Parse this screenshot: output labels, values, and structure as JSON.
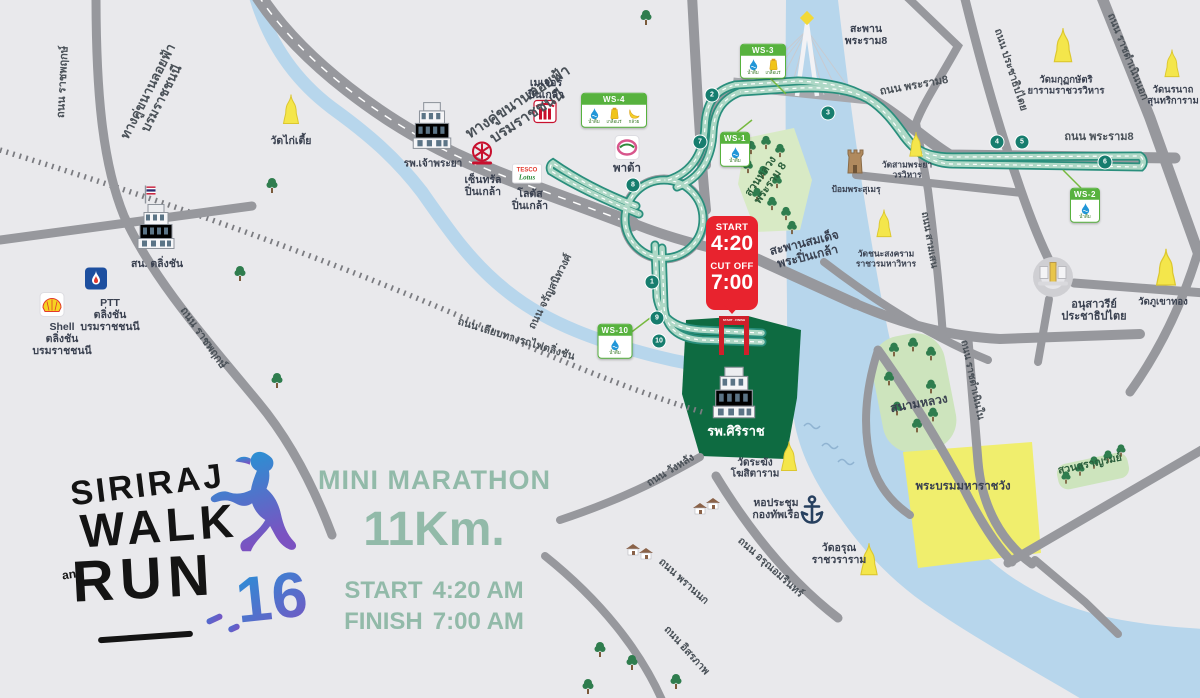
{
  "colors": {
    "background": "#e9e9ec",
    "road_gray": "#97989d",
    "route_teal": "#2a8f7d",
    "route_fill": "#aed8c6",
    "river_blue": "#b7d6ec",
    "park_green": "#cde4bd",
    "siriraj_green": "#0e6b41",
    "palace_yellow": "#f0ee6d",
    "temple_yellow": "#f4e64b",
    "ws_green": "#57b23e",
    "start_red": "#e8232e",
    "sage_text": "#92baa9",
    "label_dark": "#3a4150",
    "logo_gradient_start": "#2196d9",
    "logo_gradient_end": "#7b52c1"
  },
  "logo": {
    "siriraj": "SIRIRAJ",
    "walk": "WALK",
    "and": "and",
    "run": "RUN",
    "number": "16"
  },
  "info": {
    "title": "MINI MARATHON",
    "distance": "11Km.",
    "start_label": "START",
    "start_value": "4:20 AM",
    "finish_label": "FINISH",
    "finish_value": "7:00 AM"
  },
  "start_badge": {
    "start_label": "START",
    "start_time": "4:20",
    "cutoff_label": "CUT OFF",
    "cutoff_time": "7:00"
  },
  "start_gate": {
    "label": "START - FINISH"
  },
  "ws_items": {
    "water": "น้ำดื่ม",
    "electrolyte": "เกลือแร่",
    "banana": "กล้วย"
  },
  "water_stations": [
    {
      "id": "WS-1",
      "x": 735,
      "y": 149,
      "items": [
        "water"
      ]
    },
    {
      "id": "WS-2",
      "x": 1085,
      "y": 205,
      "items": [
        "water"
      ]
    },
    {
      "id": "WS-3",
      "x": 763,
      "y": 61,
      "items": [
        "water",
        "electrolyte"
      ]
    },
    {
      "id": "WS-4",
      "x": 614,
      "y": 110,
      "items": [
        "water",
        "electrolyte",
        "banana"
      ]
    },
    {
      "id": "WS-10",
      "x": 615,
      "y": 341,
      "items": [
        "water"
      ]
    }
  ],
  "km_markers": [
    {
      "n": "1",
      "x": 652,
      "y": 282
    },
    {
      "n": "2",
      "x": 712,
      "y": 95
    },
    {
      "n": "3",
      "x": 828,
      "y": 113
    },
    {
      "n": "4",
      "x": 997,
      "y": 142
    },
    {
      "n": "5",
      "x": 1022,
      "y": 142
    },
    {
      "n": "6",
      "x": 1105,
      "y": 162
    },
    {
      "n": "7",
      "x": 700,
      "y": 142
    },
    {
      "n": "8",
      "x": 633,
      "y": 185
    },
    {
      "n": "9",
      "x": 657,
      "y": 318
    },
    {
      "n": "10",
      "x": 659,
      "y": 341
    }
  ],
  "labels": [
    {
      "name": "road-label-elevated-parallel-west",
      "lines": [
        "ทางคู่ขนานลอยฟ้า",
        "บรมราชชนนี"
      ],
      "x": 155,
      "y": 95,
      "rot": -63,
      "size": 13,
      "color": "#4a5158"
    },
    {
      "name": "road-label-elevated-parallel",
      "lines": [
        "ทางคู่ขนานลอยฟ้า",
        "บรมราชชนนี"
      ],
      "x": 523,
      "y": 110,
      "rot": -33,
      "size": 15,
      "color": "#4a5158"
    },
    {
      "name": "road-label-ratchaphruek-north",
      "lines": [
        "ถนน ราชพฤกษ์"
      ],
      "x": 63,
      "y": 82,
      "rot": -87,
      "size": 11,
      "color": "#4a5158"
    },
    {
      "name": "road-label-ratchaphruek-south",
      "lines": [
        "ถนน ราชพฤกษ์"
      ],
      "x": 203,
      "y": 338,
      "rot": 55,
      "size": 11,
      "color": "#4a5158"
    },
    {
      "name": "road-label-railway-side",
      "lines": [
        "ถนน เลียบทางรถไฟตลิ่งชัน"
      ],
      "x": 516,
      "y": 340,
      "rot": 17,
      "size": 10.5,
      "color": "#4a5158"
    },
    {
      "name": "road-label-charansanitwong",
      "lines": [
        "ถนน จรัญสนิทวงศ์"
      ],
      "x": 551,
      "y": 292,
      "rot": -63,
      "size": 10.5,
      "color": "#4a5158"
    },
    {
      "name": "road-label-rama8-west",
      "lines": [
        "ถนน พระราม8"
      ],
      "x": 914,
      "y": 86,
      "rot": -10,
      "size": 11,
      "color": "#4a5158"
    },
    {
      "name": "road-label-rama8-east",
      "lines": [
        "ถนน พระราม8"
      ],
      "x": 1099,
      "y": 137,
      "rot": 0,
      "size": 11,
      "color": "#4a5158"
    },
    {
      "name": "road-label-prachathipatai",
      "lines": [
        "ถนน ประชาธิปไตย"
      ],
      "x": 1010,
      "y": 70,
      "rot": 72,
      "size": 10.5,
      "color": "#4a5158"
    },
    {
      "name": "road-label-ratchadamnoen-nok",
      "lines": [
        "ถนน ราชดำเนินนอก"
      ],
      "x": 1127,
      "y": 57,
      "rot": 68,
      "size": 10.5,
      "color": "#4a5158"
    },
    {
      "name": "road-label-samsen",
      "lines": [
        "ถนน สามเสน"
      ],
      "x": 929,
      "y": 240,
      "rot": 80,
      "size": 10,
      "color": "#4a5158"
    },
    {
      "name": "road-label-ratchadamnoen-nai",
      "lines": [
        "ถนน ราชดำเนินใน"
      ],
      "x": 972,
      "y": 380,
      "rot": 78,
      "size": 10,
      "color": "#4a5158"
    },
    {
      "name": "road-label-wanglang",
      "lines": [
        "ถนน วังหลัง"
      ],
      "x": 671,
      "y": 471,
      "rot": -31,
      "size": 10.5,
      "color": "#4a5158"
    },
    {
      "name": "road-label-phrannok",
      "lines": [
        "ถนน พรานนก"
      ],
      "x": 683,
      "y": 582,
      "rot": 42,
      "size": 10.5,
      "color": "#4a5158"
    },
    {
      "name": "road-label-arunamarin",
      "lines": [
        "ถนน อรุณอมรินทร์"
      ],
      "x": 770,
      "y": 568,
      "rot": 42,
      "size": 10.5,
      "color": "#4a5158"
    },
    {
      "name": "road-label-itsaraphap",
      "lines": [
        "ถนน อิสรภาพ"
      ],
      "x": 686,
      "y": 651,
      "rot": 48,
      "size": 10.5,
      "color": "#4a5158"
    },
    {
      "name": "label-wat-kai-tia",
      "lines": [
        "วัดไก่เตี้ย"
      ],
      "x": 291,
      "y": 142,
      "rot": 0,
      "size": 10.5
    },
    {
      "name": "label-taling-chan-police",
      "lines": [
        "สน. ตลิ่งชัน"
      ],
      "x": 157,
      "y": 265,
      "rot": 0,
      "size": 10.5
    },
    {
      "name": "label-ptt-station",
      "lines": [
        "PTT",
        "ตลิ่งชัน",
        "บรมราชชนนี"
      ],
      "x": 110,
      "y": 316,
      "rot": 0,
      "size": 10.5
    },
    {
      "name": "label-shell-station",
      "lines": [
        "Shell",
        "ตลิ่งชัน",
        "บรมราชชนนี"
      ],
      "x": 62,
      "y": 340,
      "rot": 0,
      "size": 10.5
    },
    {
      "name": "label-chaophraya-hospital",
      "lines": [
        "รพ.เจ้าพระยา"
      ],
      "x": 433,
      "y": 164,
      "rot": 0,
      "size": 10
    },
    {
      "name": "label-central-pinklao",
      "lines": [
        "เซ็นทรัล",
        "ปิ่นเกล้า"
      ],
      "x": 483,
      "y": 187,
      "rot": 0,
      "size": 10.5
    },
    {
      "name": "label-major-pinklao",
      "lines": [
        "เมเจอร์",
        "ปิ่นเกล้า"
      ],
      "x": 546,
      "y": 90,
      "rot": 0,
      "size": 10.5
    },
    {
      "name": "label-lotus-pinklao",
      "lines": [
        "โลตัส",
        "ปิ่นเกล้า"
      ],
      "x": 530,
      "y": 201,
      "rot": 0,
      "size": 10.5
    },
    {
      "name": "label-pata",
      "lines": [
        "พาต้า"
      ],
      "x": 627,
      "y": 169,
      "rot": 0,
      "size": 11.5
    },
    {
      "name": "label-rama8-bridge",
      "lines": [
        "สะพาน",
        "พระราม8"
      ],
      "x": 866,
      "y": 36,
      "rot": 0,
      "size": 10.5
    },
    {
      "name": "label-wat-makut",
      "lines": [
        "วัดมกุฏกษัตริ",
        "ยารามราชวรวิหาร"
      ],
      "x": 1066,
      "y": 86,
      "rot": 0,
      "size": 9.5
    },
    {
      "name": "label-wat-noranat",
      "lines": [
        "วัดนรนาถ",
        "สุนทริการาม"
      ],
      "x": 1173,
      "y": 96,
      "rot": 0,
      "size": 9.5
    },
    {
      "name": "label-rama8-park",
      "lines": [
        "สวนหลวง",
        "พระราม 8"
      ],
      "x": 766,
      "y": 180,
      "rot": -55,
      "size": 11,
      "color": "#2c5f3c"
    },
    {
      "name": "label-phra-sumen-fort",
      "lines": [
        "ป้อมพระสุเมรุ"
      ],
      "x": 856,
      "y": 190,
      "rot": 0,
      "size": 8.5
    },
    {
      "name": "label-wat-samphraya",
      "lines": [
        "วัดสามพระยา",
        "วรวิหาร"
      ],
      "x": 907,
      "y": 170,
      "rot": 0,
      "size": 8.5
    },
    {
      "name": "label-wat-chanasongkhram",
      "lines": [
        "วัดชนะสงคราม",
        "ราชวรมหาวิหาร"
      ],
      "x": 886,
      "y": 259,
      "rot": 0,
      "size": 8.5
    },
    {
      "name": "label-pinklao-bridge",
      "lines": [
        "สะพานสมเด็จ",
        "พระปิ่นเกล้า"
      ],
      "x": 806,
      "y": 250,
      "rot": -14,
      "size": 12
    },
    {
      "name": "label-democracy-monument",
      "lines": [
        "อนุสาวรีย์",
        "ประชาธิปไตย"
      ],
      "x": 1094,
      "y": 311,
      "rot": 0,
      "size": 11
    },
    {
      "name": "label-wat-phukhaothong",
      "lines": [
        "วัดภูเขาทอง"
      ],
      "x": 1163,
      "y": 303,
      "rot": 0,
      "size": 9.5
    },
    {
      "name": "label-sanam-luang",
      "lines": [
        "สนามหลวง"
      ],
      "x": 919,
      "y": 404,
      "rot": -10,
      "size": 12
    },
    {
      "name": "label-grand-palace",
      "lines": [
        "พระบรมมหาราชวัง"
      ],
      "x": 963,
      "y": 487,
      "rot": 0,
      "size": 11.5
    },
    {
      "name": "label-saranrom-park",
      "lines": [
        "สวนสราญรมย์"
      ],
      "x": 1090,
      "y": 465,
      "rot": -12,
      "size": 10.5,
      "color": "#2c5f3c"
    },
    {
      "name": "label-siriraj-hospital",
      "lines": [
        "รพ.ศิริราช"
      ],
      "x": 736,
      "y": 432,
      "rot": 0,
      "size": 13,
      "color": "#ffffff"
    },
    {
      "name": "label-wat-rakhang",
      "lines": [
        "วัดระฆัง",
        "โฆสิตาราม"
      ],
      "x": 755,
      "y": 469,
      "rot": 0,
      "size": 10
    },
    {
      "name": "label-navy-hall",
      "lines": [
        "หอประชุม",
        "กองทัพเรือ"
      ],
      "x": 776,
      "y": 510,
      "rot": 0,
      "size": 10.5
    },
    {
      "name": "label-wat-arun",
      "lines": [
        "วัดอรุณ",
        "ราชวราราม"
      ],
      "x": 839,
      "y": 555,
      "rot": 0,
      "size": 10.5
    }
  ],
  "landmarks": [
    {
      "name": "wat-kai-tia-temple-icon",
      "icon": "temple-icon",
      "x": 291,
      "y": 112,
      "s": 1
    },
    {
      "name": "wat-makut-temple-icon",
      "icon": "temple-icon",
      "x": 1063,
      "y": 48,
      "s": 1.15
    },
    {
      "name": "wat-noranat-temple-icon",
      "icon": "temple-icon",
      "x": 1172,
      "y": 66,
      "s": 0.95
    },
    {
      "name": "wat-samphraya-temple-icon",
      "icon": "temple-icon",
      "x": 916,
      "y": 147,
      "s": 0.85
    },
    {
      "name": "wat-chanasongkhram-temple-icon",
      "icon": "temple-icon",
      "x": 884,
      "y": 226,
      "s": 0.95
    },
    {
      "name": "wat-phukhaothong-temple-icon",
      "icon": "temple-icon",
      "x": 1166,
      "y": 270,
      "s": 1.25
    },
    {
      "name": "wat-rakhang-temple-icon",
      "icon": "temple-icon",
      "x": 789,
      "y": 459,
      "s": 1
    },
    {
      "name": "wat-arun-temple-icon",
      "icon": "temple-icon",
      "x": 869,
      "y": 562,
      "s": 1.1
    },
    {
      "name": "phra-sumen-fort-icon",
      "icon": "fort-icon",
      "x": 855,
      "y": 164,
      "s": 1
    },
    {
      "name": "democracy-monument-icon",
      "icon": "monument-icon",
      "x": 1053,
      "y": 276,
      "s": 1
    },
    {
      "name": "navy-anchor-icon",
      "icon": "anchor-icon",
      "x": 812,
      "y": 513,
      "s": 1
    },
    {
      "name": "police-station-building-icon",
      "icon": "building-icon",
      "x": 156,
      "y": 229,
      "s": 1
    },
    {
      "name": "thai-flag-icon",
      "icon": "flag-icon",
      "x": 150,
      "y": 197,
      "s": 1
    },
    {
      "name": "chaophraya-hospital-building-icon",
      "icon": "building-icon",
      "x": 432,
      "y": 128,
      "s": 1.05
    },
    {
      "name": "siriraj-hospital-building-icon",
      "icon": "building-icon",
      "x": 734,
      "y": 395,
      "s": 1.15
    },
    {
      "name": "ptt-icon",
      "icon": "ptt-icon",
      "x": 96,
      "y": 281,
      "s": 1
    },
    {
      "name": "shell-icon",
      "icon": "shell-icon",
      "x": 52,
      "y": 307,
      "s": 1
    },
    {
      "name": "central-icon",
      "icon": "central-icon",
      "x": 482,
      "y": 156,
      "s": 1
    },
    {
      "name": "major-icon",
      "icon": "major-icon",
      "x": 545,
      "y": 114,
      "s": 1
    },
    {
      "name": "lotus-icon",
      "icon": "lotus-icon",
      "x": 527,
      "y": 176,
      "s": 1
    },
    {
      "name": "pata-icon",
      "icon": "pata-icon",
      "x": 627,
      "y": 150,
      "s": 1
    },
    {
      "name": "house-icon",
      "icon": "house-icon",
      "x": 700,
      "y": 511,
      "s": 1
    },
    {
      "name": "house-icon",
      "icon": "house-icon",
      "x": 713,
      "y": 506,
      "s": 1
    },
    {
      "name": "house-icon",
      "icon": "house-icon",
      "x": 633,
      "y": 552,
      "s": 1
    },
    {
      "name": "house-icon",
      "icon": "house-icon",
      "x": 646,
      "y": 556,
      "s": 1
    },
    {
      "name": "tree-icon",
      "icon": "tree-icon",
      "x": 272,
      "y": 188,
      "s": 1
    },
    {
      "name": "tree-icon",
      "icon": "tree-icon",
      "x": 240,
      "y": 276,
      "s": 1
    },
    {
      "name": "tree-icon",
      "icon": "tree-icon",
      "x": 277,
      "y": 383,
      "s": 1
    },
    {
      "name": "tree-icon",
      "icon": "tree-icon",
      "x": 646,
      "y": 20,
      "s": 1
    },
    {
      "name": "tree-icon",
      "icon": "tree-icon",
      "x": 751,
      "y": 150,
      "s": 0.9
    },
    {
      "name": "tree-icon",
      "icon": "tree-icon",
      "x": 766,
      "y": 145,
      "s": 0.9
    },
    {
      "name": "tree-icon",
      "icon": "tree-icon",
      "x": 780,
      "y": 153,
      "s": 0.9
    },
    {
      "name": "tree-icon",
      "icon": "tree-icon",
      "x": 748,
      "y": 169,
      "s": 0.9
    },
    {
      "name": "tree-icon",
      "icon": "tree-icon",
      "x": 763,
      "y": 175,
      "s": 0.9
    },
    {
      "name": "tree-icon",
      "icon": "tree-icon",
      "x": 777,
      "y": 184,
      "s": 0.9
    },
    {
      "name": "tree-icon",
      "icon": "tree-icon",
      "x": 757,
      "y": 197,
      "s": 0.9
    },
    {
      "name": "tree-icon",
      "icon": "tree-icon",
      "x": 772,
      "y": 206,
      "s": 0.9
    },
    {
      "name": "tree-icon",
      "icon": "tree-icon",
      "x": 786,
      "y": 216,
      "s": 0.9
    },
    {
      "name": "tree-icon",
      "icon": "tree-icon",
      "x": 792,
      "y": 230,
      "s": 0.9
    },
    {
      "name": "tree-icon",
      "icon": "tree-icon",
      "x": 894,
      "y": 352,
      "s": 0.95
    },
    {
      "name": "tree-icon",
      "icon": "tree-icon",
      "x": 913,
      "y": 347,
      "s": 0.95
    },
    {
      "name": "tree-icon",
      "icon": "tree-icon",
      "x": 931,
      "y": 356,
      "s": 0.95
    },
    {
      "name": "tree-icon",
      "icon": "tree-icon",
      "x": 889,
      "y": 381,
      "s": 0.95
    },
    {
      "name": "tree-icon",
      "icon": "tree-icon",
      "x": 931,
      "y": 389,
      "s": 0.95
    },
    {
      "name": "tree-icon",
      "icon": "tree-icon",
      "x": 897,
      "y": 411,
      "s": 0.95
    },
    {
      "name": "tree-icon",
      "icon": "tree-icon",
      "x": 917,
      "y": 428,
      "s": 0.95
    },
    {
      "name": "tree-icon",
      "icon": "tree-icon",
      "x": 933,
      "y": 417,
      "s": 0.95
    },
    {
      "name": "tree-icon",
      "icon": "tree-icon",
      "x": 1066,
      "y": 480,
      "s": 0.85
    },
    {
      "name": "tree-icon",
      "icon": "tree-icon",
      "x": 1080,
      "y": 472,
      "s": 0.85
    },
    {
      "name": "tree-icon",
      "icon": "tree-icon",
      "x": 1094,
      "y": 465,
      "s": 0.85
    },
    {
      "name": "tree-icon",
      "icon": "tree-icon",
      "x": 1108,
      "y": 459,
      "s": 0.85
    },
    {
      "name": "tree-icon",
      "icon": "tree-icon",
      "x": 1121,
      "y": 453,
      "s": 0.85
    },
    {
      "name": "tree-icon",
      "icon": "tree-icon",
      "x": 600,
      "y": 652,
      "s": 1
    },
    {
      "name": "tree-icon",
      "icon": "tree-icon",
      "x": 632,
      "y": 665,
      "s": 1
    },
    {
      "name": "tree-icon",
      "icon": "tree-icon",
      "x": 676,
      "y": 684,
      "s": 1
    },
    {
      "name": "tree-icon",
      "icon": "tree-icon",
      "x": 588,
      "y": 689,
      "s": 1
    }
  ]
}
